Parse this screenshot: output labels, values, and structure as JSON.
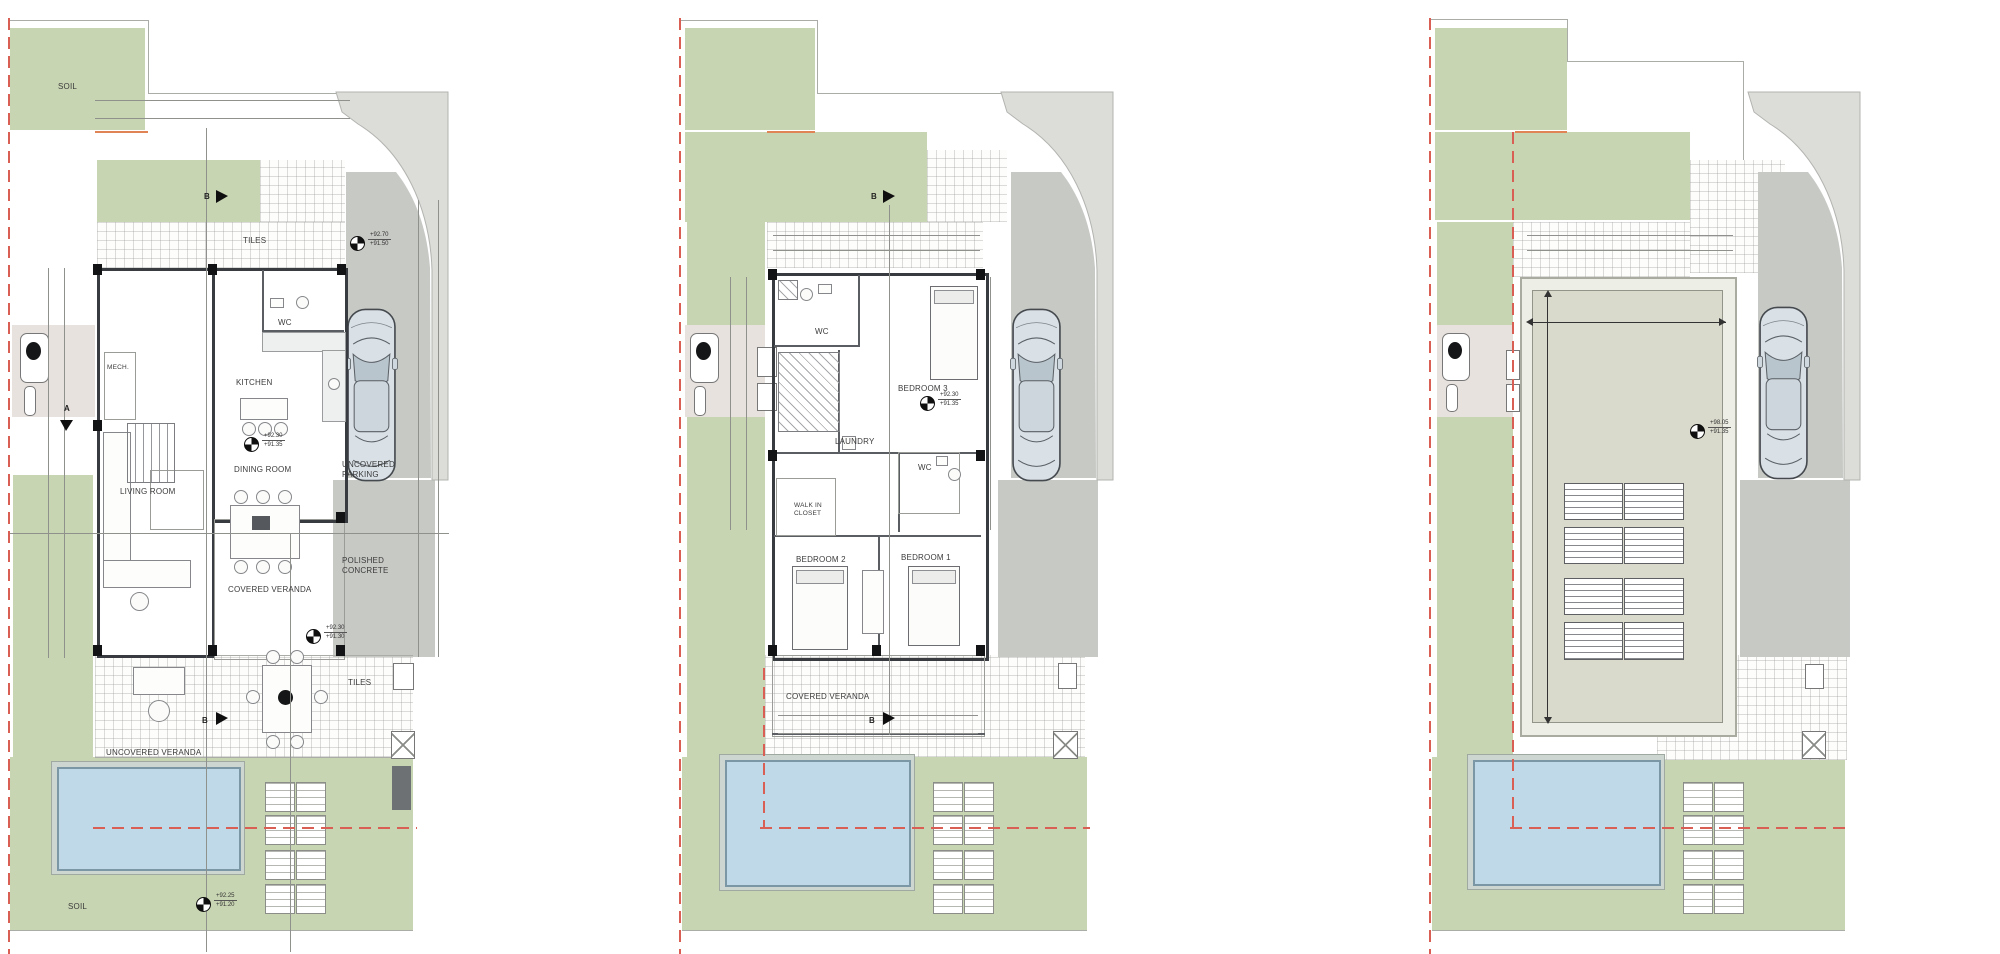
{
  "sheet": {
    "background": "#ffffff"
  },
  "colors": {
    "garden_green": "#c8d5b2",
    "paving_gray": "#c7c9c5",
    "road_gray": "#dcddd8",
    "pool_water": "#c0d9e8",
    "boundary_red": "#d95f55",
    "roof_deck": "#d9dacc"
  },
  "plans": [
    {
      "name": "ground-floor-site-plan",
      "labels": {
        "soil_top": "SOIL",
        "tiles_upper": "TILES",
        "wc": "WC",
        "mech": "MECH.",
        "kitchen": "KITCHEN",
        "dining_room": "DINING ROOM",
        "living_room": "LIVING ROOM",
        "covered_veranda": "COVERED VERANDA",
        "uncovered_parking": "UNCOVERED\nPARKING",
        "polished_concrete": "POLISHED\nCONCRETE",
        "tiles_lower": "TILES",
        "uncovered_veranda": "UNCOVERED VERANDA",
        "soil_bottom": "SOIL"
      },
      "levels": [
        {
          "top": "+92.70",
          "bottom": "+91.50"
        },
        {
          "top": "+92.30",
          "bottom": "+91.35"
        },
        {
          "top": "+92.30",
          "bottom": "+91.30"
        },
        {
          "top": "+92.25",
          "bottom": "+91.20"
        }
      ],
      "sections": {
        "b_top": "B",
        "a_left": "A",
        "b_bottom": "B"
      }
    },
    {
      "name": "first-floor-plan",
      "labels": {
        "wc_top": "WC",
        "bedroom3": "BEDROOM 3",
        "laundry": "LAUNDRY",
        "wc_mid": "WC",
        "walk_in_closet": "WALK IN\nCLOSET",
        "bedroom2": "BEDROOM 2",
        "bedroom1": "BEDROOM 1",
        "covered_veranda": "COVERED VERANDA"
      },
      "levels": [
        {
          "top": "+92.30",
          "bottom": "+91.35"
        }
      ],
      "sections": {
        "b_top": "B",
        "b_bottom": "B"
      }
    },
    {
      "name": "roof-plan",
      "levels": [
        {
          "top": "+98.05",
          "bottom": "+91.35"
        }
      ]
    }
  ]
}
